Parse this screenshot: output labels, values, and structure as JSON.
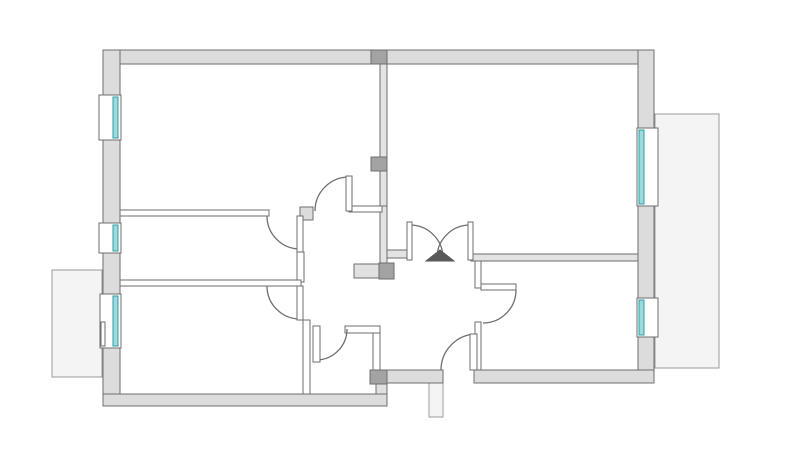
{
  "canvas": {
    "width": 800,
    "height": 455,
    "background": "#ffffff"
  },
  "palette": {
    "wall_fill": "#dcdcdc",
    "wall_stroke": "#6e6e6e",
    "thin_wall_fill": "#ffffff",
    "thin_wall_gray_fill": "#e3e3e3",
    "block_dark_fill": "#a3a3a3",
    "block_light_fill": "#e0e0e0",
    "balcony_fill": "#f4f4f4",
    "balcony_stroke": "#9a9a9a",
    "window_frame_fill": "#ffffff",
    "window_glass_fill": "#9ed9dd",
    "window_glass_stroke": "#2f9ba3",
    "door_stroke": "#6e6e6e",
    "door_leaf_fill": "#ffffff",
    "swing_triangle_fill": "#595959"
  },
  "balconies": [
    {
      "name": "balcony-right",
      "rect": [
        655,
        114,
        64,
        254
      ]
    },
    {
      "name": "balcony-left",
      "rect": [
        52,
        270,
        50,
        107
      ]
    },
    {
      "name": "entry-stub",
      "rect": [
        429,
        383,
        14,
        34
      ]
    }
  ],
  "exterior_walls": [
    {
      "name": "wall-top",
      "rect": [
        103,
        50,
        551,
        14
      ]
    },
    {
      "name": "wall-left",
      "rect": [
        103,
        50,
        17,
        356
      ]
    },
    {
      "name": "wall-bottom-left",
      "rect": [
        103,
        394,
        284,
        12
      ]
    },
    {
      "name": "wall-right",
      "rect": [
        638,
        50,
        16,
        333
      ]
    },
    {
      "name": "wall-bottom-right",
      "rect": [
        474,
        370,
        180,
        13
      ]
    },
    {
      "name": "wall-bottom-band",
      "rect": [
        387,
        370,
        56,
        13
      ]
    },
    {
      "name": "door-jamb-block",
      "rect": [
        300,
        207,
        13,
        13
      ]
    }
  ],
  "interior_walls": [
    {
      "name": "partition-main-upper",
      "rect": [
        380,
        64,
        7,
        149
      ],
      "gray": true
    },
    {
      "name": "partition-main-lower",
      "rect": [
        380,
        206,
        7,
        58
      ],
      "gray": true
    },
    {
      "name": "wall-hall-top-left",
      "rect": [
        120,
        210,
        149,
        6
      ],
      "gray": false
    },
    {
      "name": "wall-hall-top-right",
      "rect": [
        349,
        206,
        33,
        6
      ],
      "gray": false
    },
    {
      "name": "wall-doubledoor-left",
      "rect": [
        387,
        250,
        22,
        8
      ],
      "gray": true
    },
    {
      "name": "wall-doubledoor-right",
      "rect": [
        471,
        254,
        167,
        7
      ],
      "gray": true
    },
    {
      "name": "wall-room-br-left-upper",
      "rect": [
        475,
        261,
        6,
        27
      ],
      "gray": false
    },
    {
      "name": "wall-room-br-left-lower",
      "rect": [
        475,
        322,
        6,
        48
      ],
      "gray": false
    },
    {
      "name": "wall-hall-mid-post",
      "rect": [
        297,
        252,
        7,
        30
      ],
      "gray": false
    },
    {
      "name": "wall-room-ml-bottom",
      "rect": [
        120,
        280,
        181,
        6
      ],
      "gray": false
    },
    {
      "name": "wall-wc-left",
      "rect": [
        303,
        320,
        7,
        74
      ],
      "gray": false
    },
    {
      "name": "wall-wc-top",
      "rect": [
        345,
        326,
        35,
        7
      ],
      "gray": false
    },
    {
      "name": "wall-wc-right",
      "rect": [
        373,
        333,
        7,
        37
      ],
      "gray": false
    }
  ],
  "blocks": [
    {
      "name": "chimney-block-top",
      "rect": [
        371,
        50,
        16,
        14
      ],
      "fill": "dark"
    },
    {
      "name": "chimney-block-mid",
      "rect": [
        371,
        157,
        16,
        14
      ],
      "fill": "dark"
    },
    {
      "name": "shaft-block-light",
      "rect": [
        354,
        264,
        25,
        14
      ],
      "fill": "light"
    },
    {
      "name": "shaft-block-dark",
      "rect": [
        379,
        263,
        15,
        16
      ],
      "fill": "dark"
    },
    {
      "name": "bottom-step-block",
      "rect": [
        370,
        370,
        17,
        14
      ],
      "fill": "dark"
    },
    {
      "name": "bottom-step-bridge",
      "rect": [
        376,
        384,
        11,
        10
      ],
      "fill": "light"
    }
  ],
  "windows": [
    {
      "name": "window-left-top",
      "frame": [
        99,
        95,
        22,
        45
      ],
      "glass": [
        113,
        97,
        5,
        41
      ]
    },
    {
      "name": "window-left-middle",
      "frame": [
        99,
        223,
        22,
        30
      ],
      "glass": [
        113,
        225,
        5,
        26
      ]
    },
    {
      "name": "window-left-balcony",
      "frame": [
        100,
        294,
        21,
        54
      ],
      "glass": [
        113,
        296,
        5,
        50
      ],
      "leaf": [
        101,
        322,
        4,
        24
      ]
    },
    {
      "name": "window-right-top",
      "frame": [
        637,
        128,
        21,
        78
      ],
      "glass": [
        639,
        130,
        5,
        74
      ]
    },
    {
      "name": "window-right-bottom",
      "frame": [
        637,
        298,
        21,
        39
      ],
      "glass": [
        639,
        300,
        5,
        35
      ]
    }
  ],
  "doors": [
    {
      "name": "door-room-top-left",
      "leaf": [
        346,
        176,
        6,
        35
      ],
      "arc": "M315,211 A34,34 0 0 1 349,177"
    },
    {
      "name": "door-room-mid-left",
      "leaf": [
        297,
        216,
        6,
        36
      ],
      "arc": "M267,216 A33,33 0 0 0 300,249"
    },
    {
      "name": "door-room-bottom-left",
      "leaf": [
        297,
        286,
        6,
        34
      ],
      "arc": "M267,286 A33,33 0 0 0 300,319"
    },
    {
      "name": "door-wc",
      "leaf": [
        313,
        326,
        7,
        36
      ],
      "arc": "M347,329 A31,31 0 0 1 317,360"
    },
    {
      "name": "door-room-bottom-right",
      "leaf": [
        481,
        284,
        35,
        6
      ],
      "arc": "M516,290 A33,33 0 0 1 483,323"
    },
    {
      "name": "door-entry",
      "leaf": [
        470,
        334,
        7,
        36
      ],
      "arc": "M441,370 A36,36 0 0 1 477,334"
    }
  ],
  "double_door": {
    "name": "double-door-living",
    "jambs": [
      [
        407,
        222,
        5,
        38
      ],
      [
        468,
        222,
        5,
        38
      ]
    ],
    "arcs": [
      "M410,225 A33,33 0 0 1 443,258",
      "M470,225 A33,33 0 0 0 437,258"
    ],
    "triangle": "426,261 454,261 440,250"
  }
}
